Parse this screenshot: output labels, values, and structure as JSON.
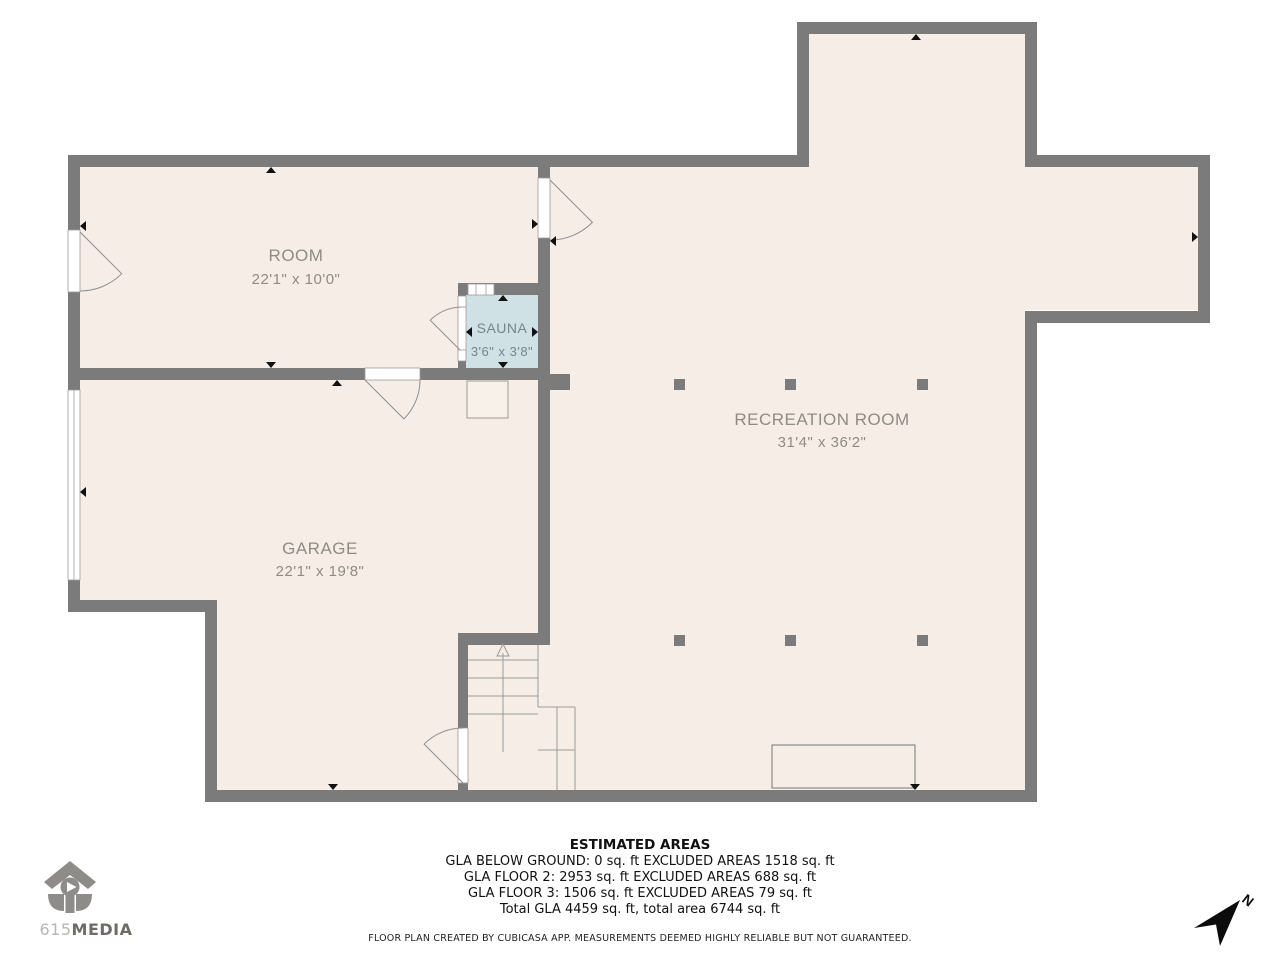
{
  "plan": {
    "rooms": [
      {
        "name": "ROOM",
        "dims": "22'1\" x 10'0\""
      },
      {
        "name": "SAUNA",
        "dims": "3'6\" x 3'8\""
      },
      {
        "name": "GARAGE",
        "dims": "22'1\" x 19'8\""
      },
      {
        "name": "RECREATION ROOM",
        "dims": "31'4\" x 36'2\""
      }
    ]
  },
  "footer": {
    "title": "ESTIMATED AREAS",
    "lines": [
      "GLA BELOW GROUND: 0 sq. ft EXCLUDED AREAS 1518 sq. ft",
      "GLA FLOOR 2: 2953 sq. ft EXCLUDED AREAS 688 sq. ft",
      "GLA FLOOR 3: 1506 sq. ft EXCLUDED AREAS 79 sq. ft",
      "Total GLA 4459 sq. ft, total area 6744 sq. ft"
    ],
    "disclaimer": "FLOOR PLAN CREATED BY CUBICASA APP. MEASUREMENTS DEEMED HIGHLY RELIABLE BUT NOT GUARANTEED."
  },
  "logo": {
    "prefix": "615",
    "suffix": "MEDIA"
  },
  "compass": {
    "label": "N"
  },
  "colors": {
    "floor": "#f5ede6",
    "sauna": "#cfe1e5",
    "wall": "#7b7b7b",
    "thin_line": "#9a9a9a",
    "label_gray": "#8f8b85",
    "black": "#111111"
  }
}
